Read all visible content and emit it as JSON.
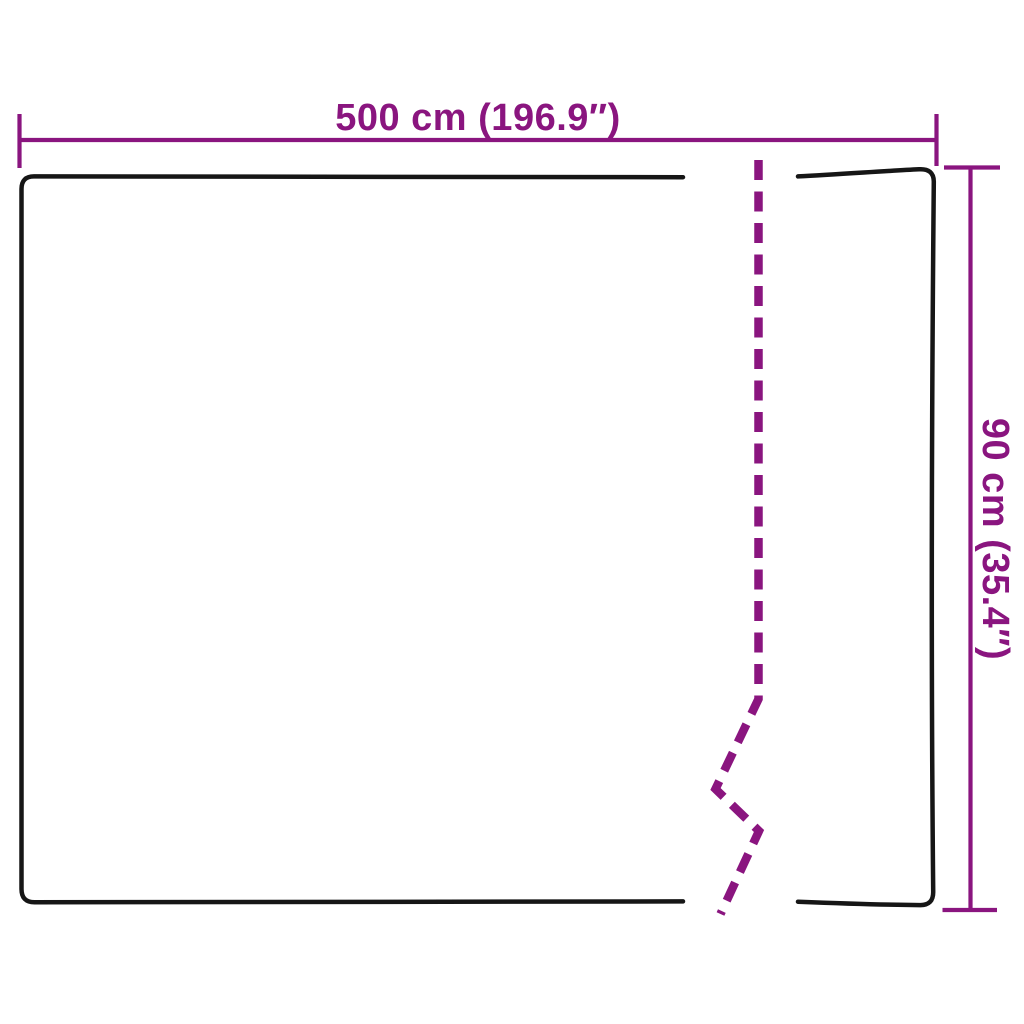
{
  "diagram": {
    "title": "product-dimensions-diagram",
    "width_label": "500 cm (196.9″)",
    "height_label": "90 cm (35.4″)",
    "width_value": "500 cm",
    "width_inches": "196.9″",
    "height_value": "90 cm",
    "height_inches": "35.4″"
  },
  "colors": {
    "accent": "#8a157f",
    "line": "#161616",
    "background": "#ffffff"
  }
}
